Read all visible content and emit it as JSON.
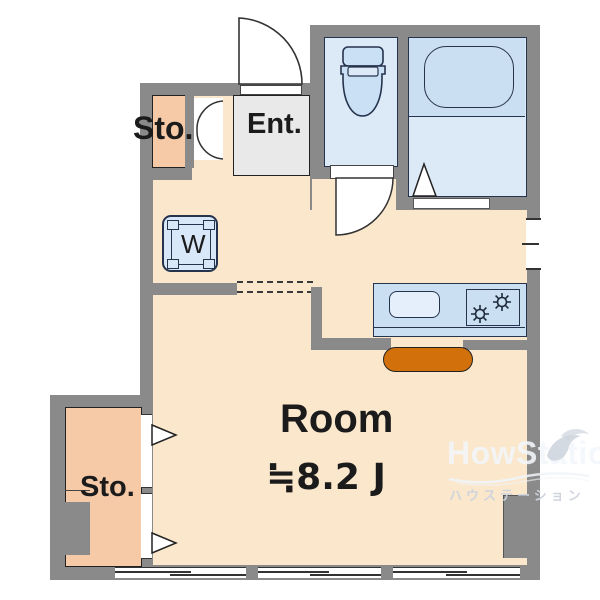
{
  "plan": {
    "rooms": {
      "storage_top": {
        "label": "Sto."
      },
      "entrance": {
        "label": "Ent."
      },
      "washer": {
        "label": "W"
      },
      "main": {
        "label": "Room",
        "area": "≒8.2 J"
      },
      "storage_bottom": {
        "label": "Sto."
      }
    },
    "watermark": {
      "brand": "HowStation",
      "caption": "ハウステーション"
    },
    "colors": {
      "wall": "#8A8A8A",
      "floor": "#FAE7CC",
      "storage": "#F6C9A7",
      "entrance_floor": "#E9E9E9",
      "wet_room": "#DCEAF8",
      "wet_room_dark": "#CBDFF3",
      "kitchen_counter": "#CBDFF3",
      "kitchen_mat": "#D2710B",
      "outline": "#26334D"
    },
    "icons": [
      "entrance-door",
      "folding-door",
      "toilet",
      "bathtub",
      "shower-door-triangle",
      "washing-machine",
      "kitchen-sink",
      "stove-burners",
      "opening-arrow",
      "window",
      "watermark-bird"
    ]
  }
}
